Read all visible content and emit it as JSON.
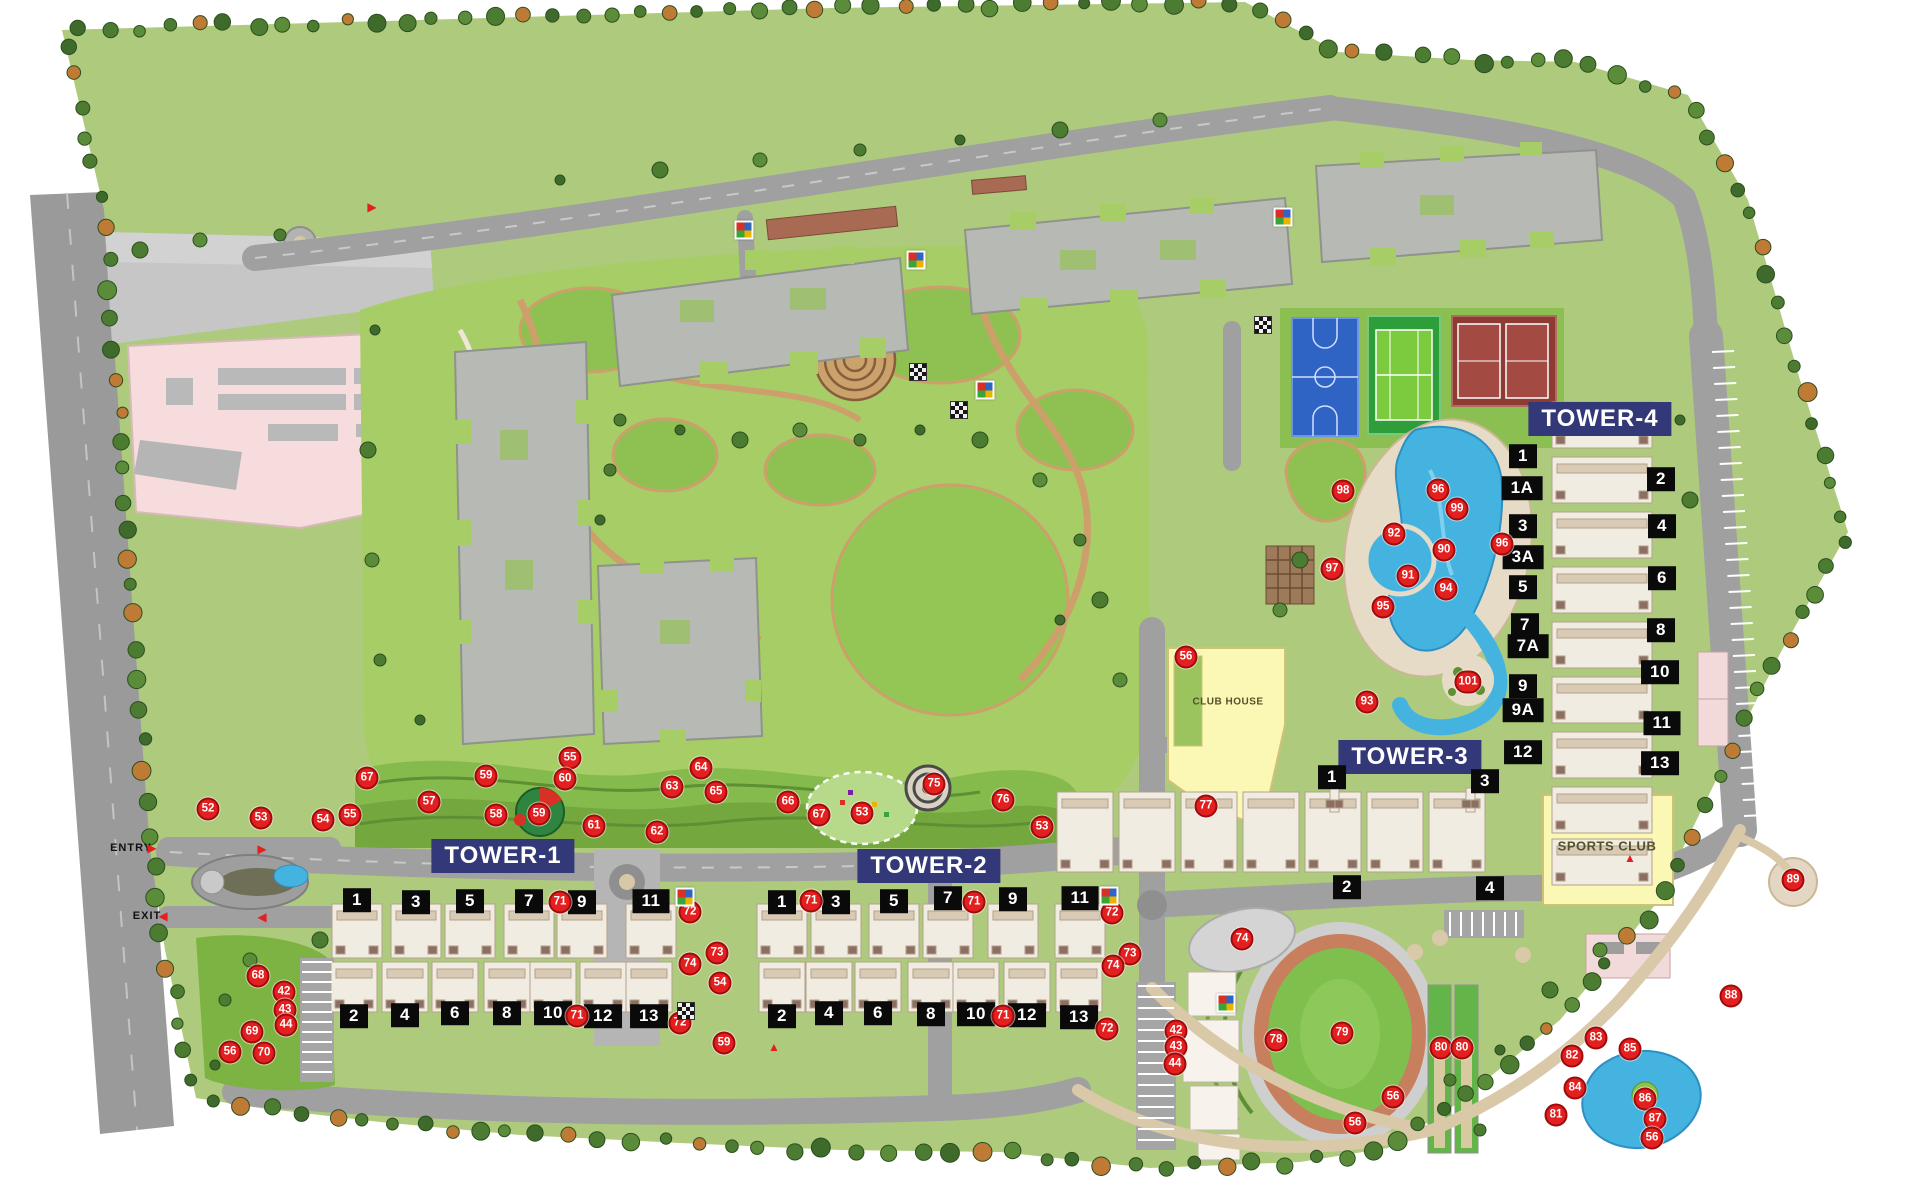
{
  "site": {
    "entry": "ENTRY",
    "exit": "EXIT"
  },
  "amenities": [
    {
      "label": "CLUB HOUSE",
      "x": 1228,
      "y": 702,
      "size": "sm"
    },
    {
      "label": "SPORTS CLUB",
      "x": 1607,
      "y": 846,
      "size": "lg"
    }
  ],
  "towers": [
    {
      "name": "TOWER-1",
      "x": 503,
      "y": 856,
      "badges": [
        [
          "1",
          357,
          900
        ],
        [
          "3",
          416,
          902
        ],
        [
          "5",
          470,
          901
        ],
        [
          "7",
          529,
          901
        ],
        [
          "9",
          582,
          902
        ],
        [
          "11",
          651,
          901
        ],
        [
          "2",
          354,
          1016
        ],
        [
          "4",
          405,
          1015
        ],
        [
          "6",
          455,
          1013
        ],
        [
          "8",
          507,
          1013
        ],
        [
          "10",
          553,
          1013
        ],
        [
          "12",
          603,
          1016
        ],
        [
          "13",
          649,
          1016
        ]
      ]
    },
    {
      "name": "TOWER-2",
      "x": 929,
      "y": 866,
      "badges": [
        [
          "1",
          782,
          902
        ],
        [
          "3",
          836,
          902
        ],
        [
          "5",
          894,
          901
        ],
        [
          "7",
          948,
          898
        ],
        [
          "9",
          1013,
          899
        ],
        [
          "11",
          1080,
          898
        ],
        [
          "2",
          782,
          1016
        ],
        [
          "4",
          829,
          1013
        ],
        [
          "6",
          878,
          1013
        ],
        [
          "8",
          931,
          1014
        ],
        [
          "10",
          976,
          1014
        ],
        [
          "12",
          1027,
          1015
        ],
        [
          "13",
          1079,
          1017
        ]
      ]
    },
    {
      "name": "TOWER-3",
      "x": 1410,
      "y": 757,
      "badges": [
        [
          "1",
          1332,
          777
        ],
        [
          "3",
          1485,
          781
        ],
        [
          "2",
          1347,
          887
        ],
        [
          "4",
          1490,
          888
        ]
      ]
    },
    {
      "name": "TOWER-4",
      "x": 1600,
      "y": 419,
      "badges": [
        [
          "1",
          1523,
          456
        ],
        [
          "1A",
          1522,
          488
        ],
        [
          "3",
          1523,
          526
        ],
        [
          "3A",
          1523,
          557
        ],
        [
          "5",
          1523,
          587
        ],
        [
          "7",
          1525,
          625
        ],
        [
          "7A",
          1528,
          646
        ],
        [
          "9",
          1523,
          686
        ],
        [
          "9A",
          1523,
          710
        ],
        [
          "12",
          1523,
          752
        ],
        [
          "2",
          1661,
          479
        ],
        [
          "4",
          1662,
          526
        ],
        [
          "6",
          1662,
          578
        ],
        [
          "8",
          1661,
          630
        ],
        [
          "10",
          1660,
          672
        ],
        [
          "11",
          1662,
          723
        ],
        [
          "13",
          1660,
          763
        ]
      ]
    }
  ],
  "markers": [
    [
      "52",
      208,
      809
    ],
    [
      "53",
      261,
      818
    ],
    [
      "54",
      323,
      820
    ],
    [
      "55",
      350,
      815
    ],
    [
      "67",
      367,
      778
    ],
    [
      "59",
      486,
      776
    ],
    [
      "57",
      429,
      802
    ],
    [
      "58",
      496,
      815
    ],
    [
      "59",
      539,
      814
    ],
    [
      "55",
      570,
      758
    ],
    [
      "60",
      565,
      779
    ],
    [
      "61",
      594,
      826
    ],
    [
      "62",
      657,
      832
    ],
    [
      "63",
      672,
      787
    ],
    [
      "64",
      701,
      768
    ],
    [
      "65",
      716,
      792
    ],
    [
      "66",
      788,
      802
    ],
    [
      "67",
      819,
      815
    ],
    [
      "53",
      862,
      813
    ],
    [
      "75",
      934,
      784
    ],
    [
      "76",
      1003,
      800
    ],
    [
      "53",
      1042,
      827
    ],
    [
      "71",
      560,
      902
    ],
    [
      "71",
      577,
      1016
    ],
    [
      "72",
      690,
      912
    ],
    [
      "74",
      690,
      964
    ],
    [
      "73",
      717,
      953
    ],
    [
      "54",
      720,
      983
    ],
    [
      "72",
      680,
      1023
    ],
    [
      "59",
      724,
      1043
    ],
    [
      "71",
      811,
      901
    ],
    [
      "71",
      974,
      902
    ],
    [
      "71",
      1003,
      1016
    ],
    [
      "72",
      1112,
      913
    ],
    [
      "73",
      1130,
      954
    ],
    [
      "74",
      1113,
      966
    ],
    [
      "72",
      1107,
      1029
    ],
    [
      "68",
      258,
      976
    ],
    [
      "42",
      284,
      992
    ],
    [
      "43",
      285,
      1010
    ],
    [
      "44",
      286,
      1025
    ],
    [
      "69",
      252,
      1032
    ],
    [
      "56",
      230,
      1052
    ],
    [
      "70",
      264,
      1053
    ],
    [
      "56",
      1186,
      657
    ],
    [
      "77",
      1206,
      806
    ],
    [
      "93",
      1367,
      702
    ],
    [
      "101",
      1468,
      682
    ],
    [
      "98",
      1343,
      491
    ],
    [
      "96",
      1438,
      490
    ],
    [
      "99",
      1457,
      509
    ],
    [
      "92",
      1394,
      534
    ],
    [
      "90",
      1444,
      550
    ],
    [
      "91",
      1408,
      576
    ],
    [
      "94",
      1446,
      589
    ],
    [
      "95",
      1383,
      607
    ],
    [
      "96",
      1502,
      544
    ],
    [
      "97",
      1332,
      569
    ],
    [
      "74",
      1242,
      939
    ],
    [
      "78",
      1276,
      1040
    ],
    [
      "79",
      1342,
      1033
    ],
    [
      "80",
      1441,
      1048
    ],
    [
      "80",
      1462,
      1048
    ],
    [
      "56",
      1393,
      1097
    ],
    [
      "56",
      1355,
      1123
    ],
    [
      "42",
      1176,
      1031
    ],
    [
      "43",
      1176,
      1047
    ],
    [
      "44",
      1175,
      1064
    ],
    [
      "88",
      1731,
      996
    ],
    [
      "83",
      1596,
      1038
    ],
    [
      "82",
      1572,
      1056
    ],
    [
      "85",
      1630,
      1049
    ],
    [
      "84",
      1575,
      1088
    ],
    [
      "86",
      1645,
      1099
    ],
    [
      "87",
      1655,
      1119
    ],
    [
      "81",
      1556,
      1115
    ],
    [
      "56",
      1652,
      1138
    ],
    [
      "89",
      1793,
      880
    ]
  ],
  "icons": {
    "colored": [
      [
        744,
        230
      ],
      [
        916,
        260
      ],
      [
        985,
        390
      ],
      [
        685,
        897
      ],
      [
        1109,
        896
      ],
      [
        1283,
        217
      ],
      [
        1226,
        1003
      ]
    ],
    "checkered": [
      [
        1263,
        325
      ],
      [
        918,
        372
      ],
      [
        959,
        410
      ],
      [
        686,
        1011
      ]
    ]
  },
  "arrows": [
    [
      "▶",
      152,
      848
    ],
    [
      "◀",
      163,
      916
    ],
    [
      "▶",
      262,
      849
    ],
    [
      "◀",
      262,
      917
    ],
    [
      "▲",
      774,
      1047
    ],
    [
      "▲",
      1630,
      858
    ],
    [
      "▶",
      372,
      207
    ]
  ],
  "colors": {
    "marker_bg": "#e31f1f",
    "badge_bg": "#0a0a0a",
    "tower_bg": "#323878",
    "amenity_bg": "#fbf7b4",
    "pool_blue": "#45b3e0",
    "site_green": "#aecb7d"
  }
}
